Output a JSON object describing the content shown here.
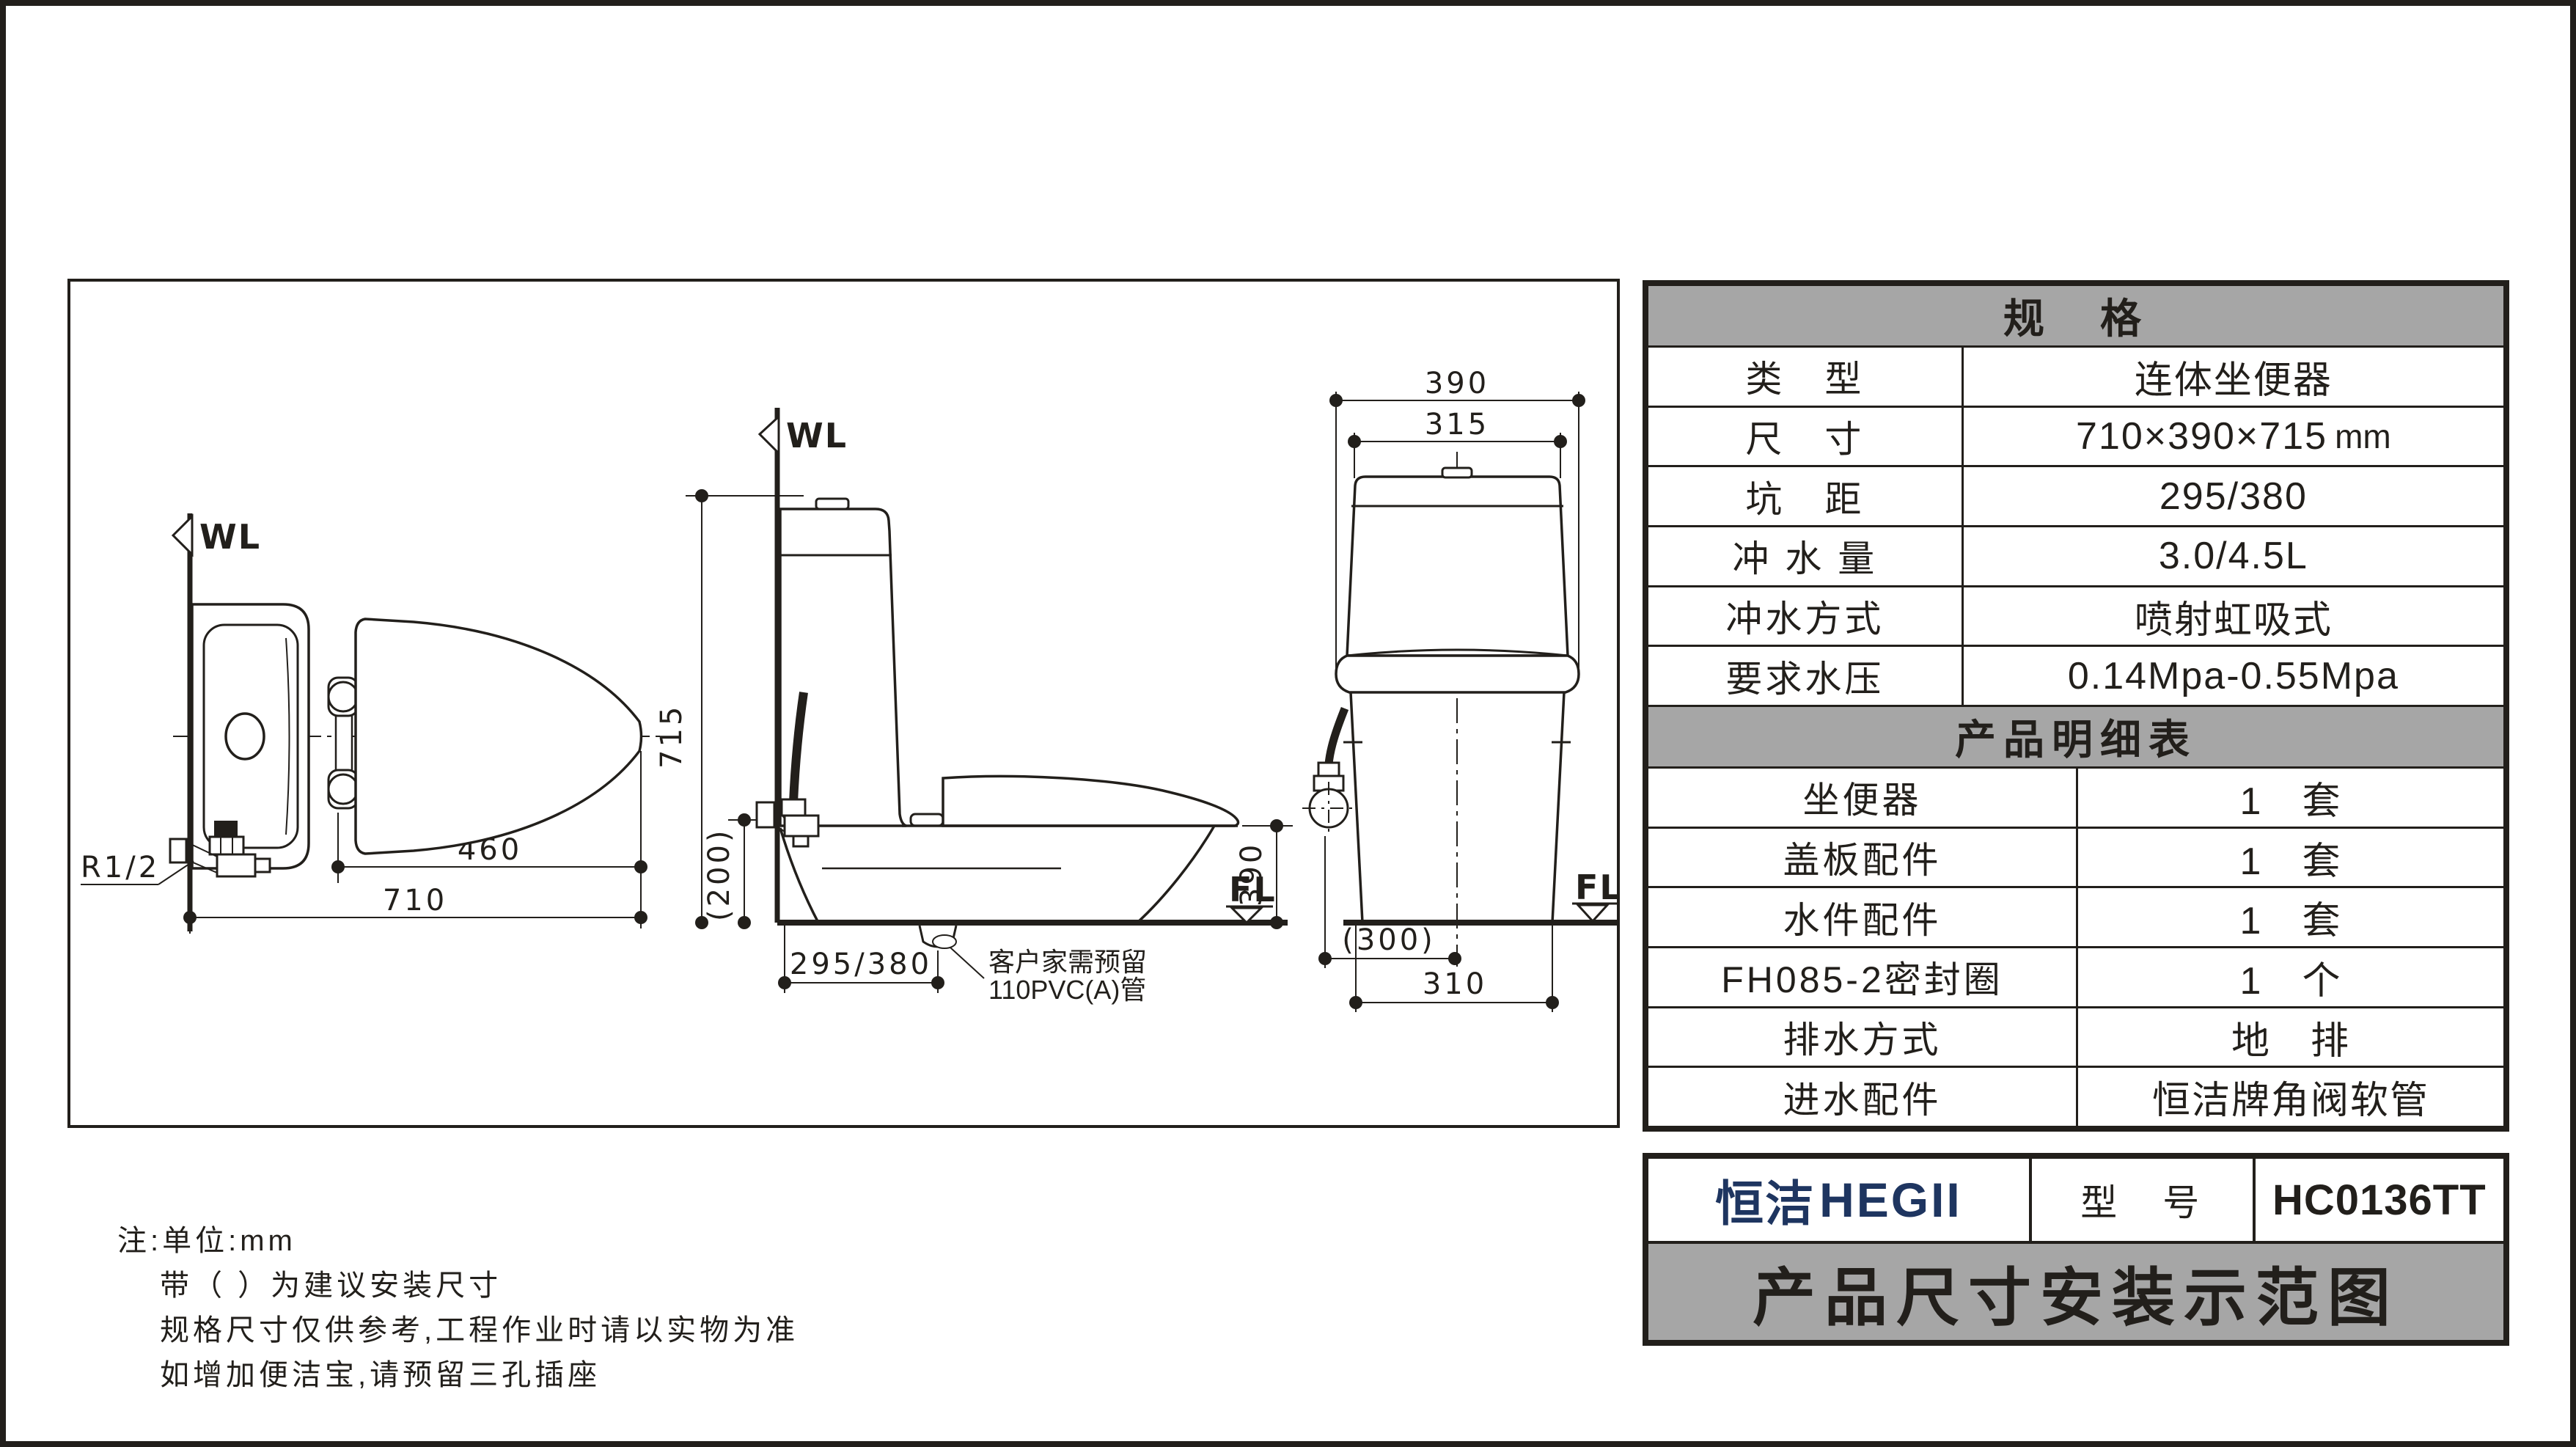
{
  "colors": {
    "ink": "#221f1b",
    "header_gray": "#a6a6a6",
    "logo_navy": "#1e3560"
  },
  "spec_table": {
    "title": "规　格",
    "rows": [
      {
        "label": "类　型",
        "value": "连体坐便器"
      },
      {
        "label": "尺　寸",
        "value": "710×390×715",
        "unit": "mm"
      },
      {
        "label": "坑　距",
        "value": "295/380"
      },
      {
        "label": "冲 水 量",
        "value": "3.0/4.5L"
      },
      {
        "label": "冲水方式",
        "value": "喷射虹吸式"
      },
      {
        "label": "要求水压",
        "value": "0.14Mpa-0.55Mpa"
      }
    ]
  },
  "detail_table": {
    "title": "产品明细表",
    "rows": [
      {
        "label": "坐便器",
        "value": "1　套"
      },
      {
        "label": "盖板配件",
        "value": "1　套"
      },
      {
        "label": "水件配件",
        "value": "1　套"
      },
      {
        "label": "FH085-2密封圈",
        "value": "1　个"
      },
      {
        "label": "排水方式",
        "value": "地　排"
      },
      {
        "label": "进水配件",
        "value": "恒洁牌角阀软管"
      }
    ]
  },
  "title_block": {
    "brand_cn": "恒洁",
    "brand_en": "HEGII",
    "model_label": "型　号",
    "model_value": "HC0136TT",
    "banner": "产品尺寸安装示范图"
  },
  "notes": [
    "注:单位:mm",
    "带（ ）为建议安装尺寸",
    "规格尺寸仅供参考,工程作业时请以实物为准",
    "如增加便洁宝,请预留三孔插座"
  ],
  "drawing": {
    "top_view": {
      "wall": "WL",
      "thread": "R1/2",
      "seat_depth": "460",
      "total_depth": "710"
    },
    "side_view": {
      "wall": "WL",
      "total_height": "715",
      "valve_height": "(200)",
      "rough_in": "295/380",
      "bowl_height": "390",
      "floor": "FL",
      "callout1": "客户家需预留",
      "callout2": "110PVC(A)管"
    },
    "front_view": {
      "total_width": "390",
      "tank_width": "315",
      "valve_offset": "(300)",
      "base_width": "310",
      "floor": "FL"
    }
  }
}
